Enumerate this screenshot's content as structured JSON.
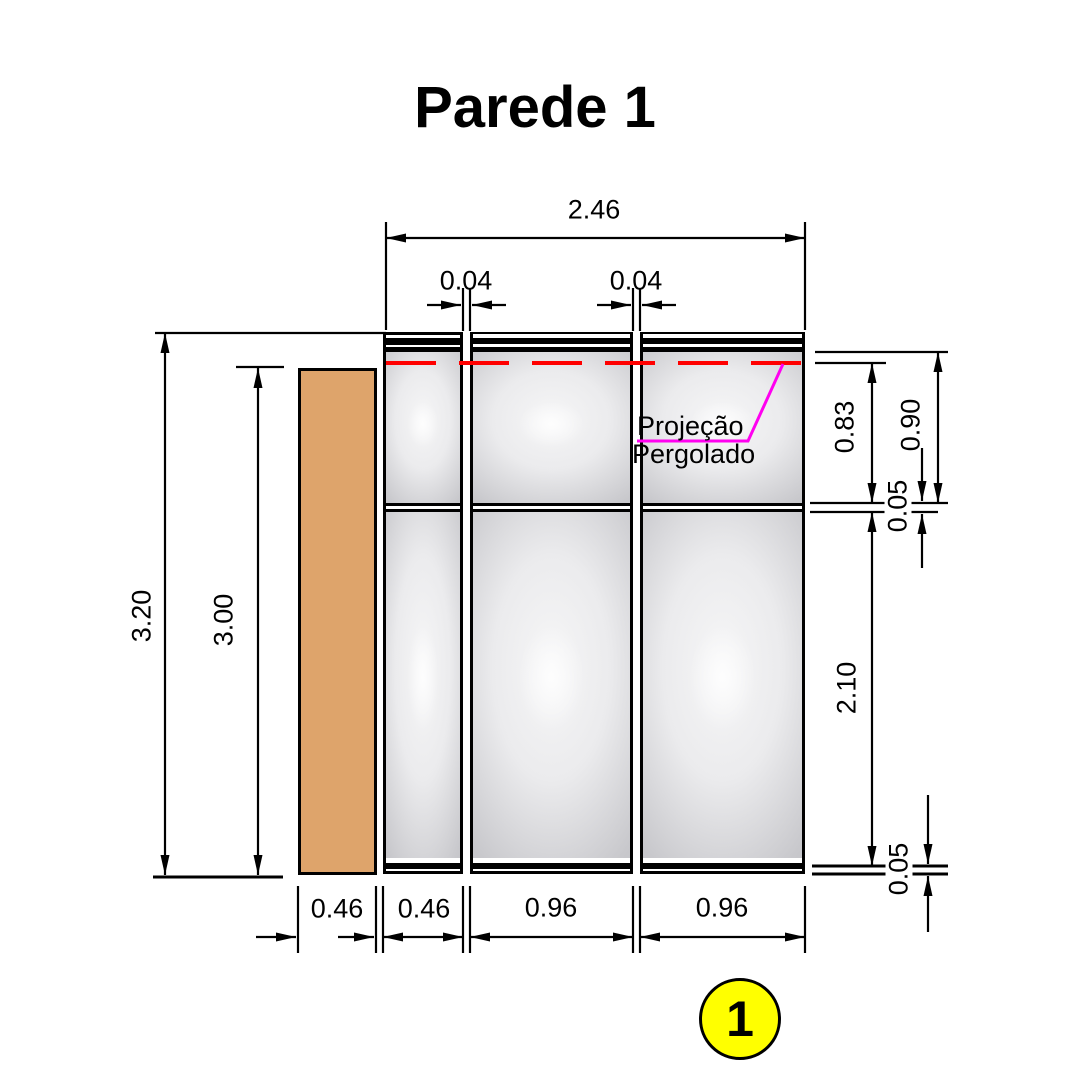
{
  "title": "Parede 1",
  "labels": {
    "projection_line1": "Projeção",
    "projection_line2": "Pergolado"
  },
  "balloon": {
    "number": "1"
  },
  "dimensions": {
    "total_width": "2.46",
    "mullion_left": "0.04",
    "mullion_right": "0.04",
    "wall_height": "3.20",
    "column_height": "3.00",
    "upper_glass_height": "0.83",
    "upper_section_height": "0.90",
    "transom_thickness": "0.05",
    "lower_glass_height": "2.10",
    "base_thickness": "0.05",
    "column_width": "0.46",
    "panel1_width": "0.46",
    "panel2_width": "0.96",
    "panel3_width": "0.96"
  },
  "colors": {
    "column_fill": "#DEA46B",
    "dash_line": "#FF0000",
    "projection_line": "#FF00F0",
    "balloon_fill": "#FFFF00"
  }
}
